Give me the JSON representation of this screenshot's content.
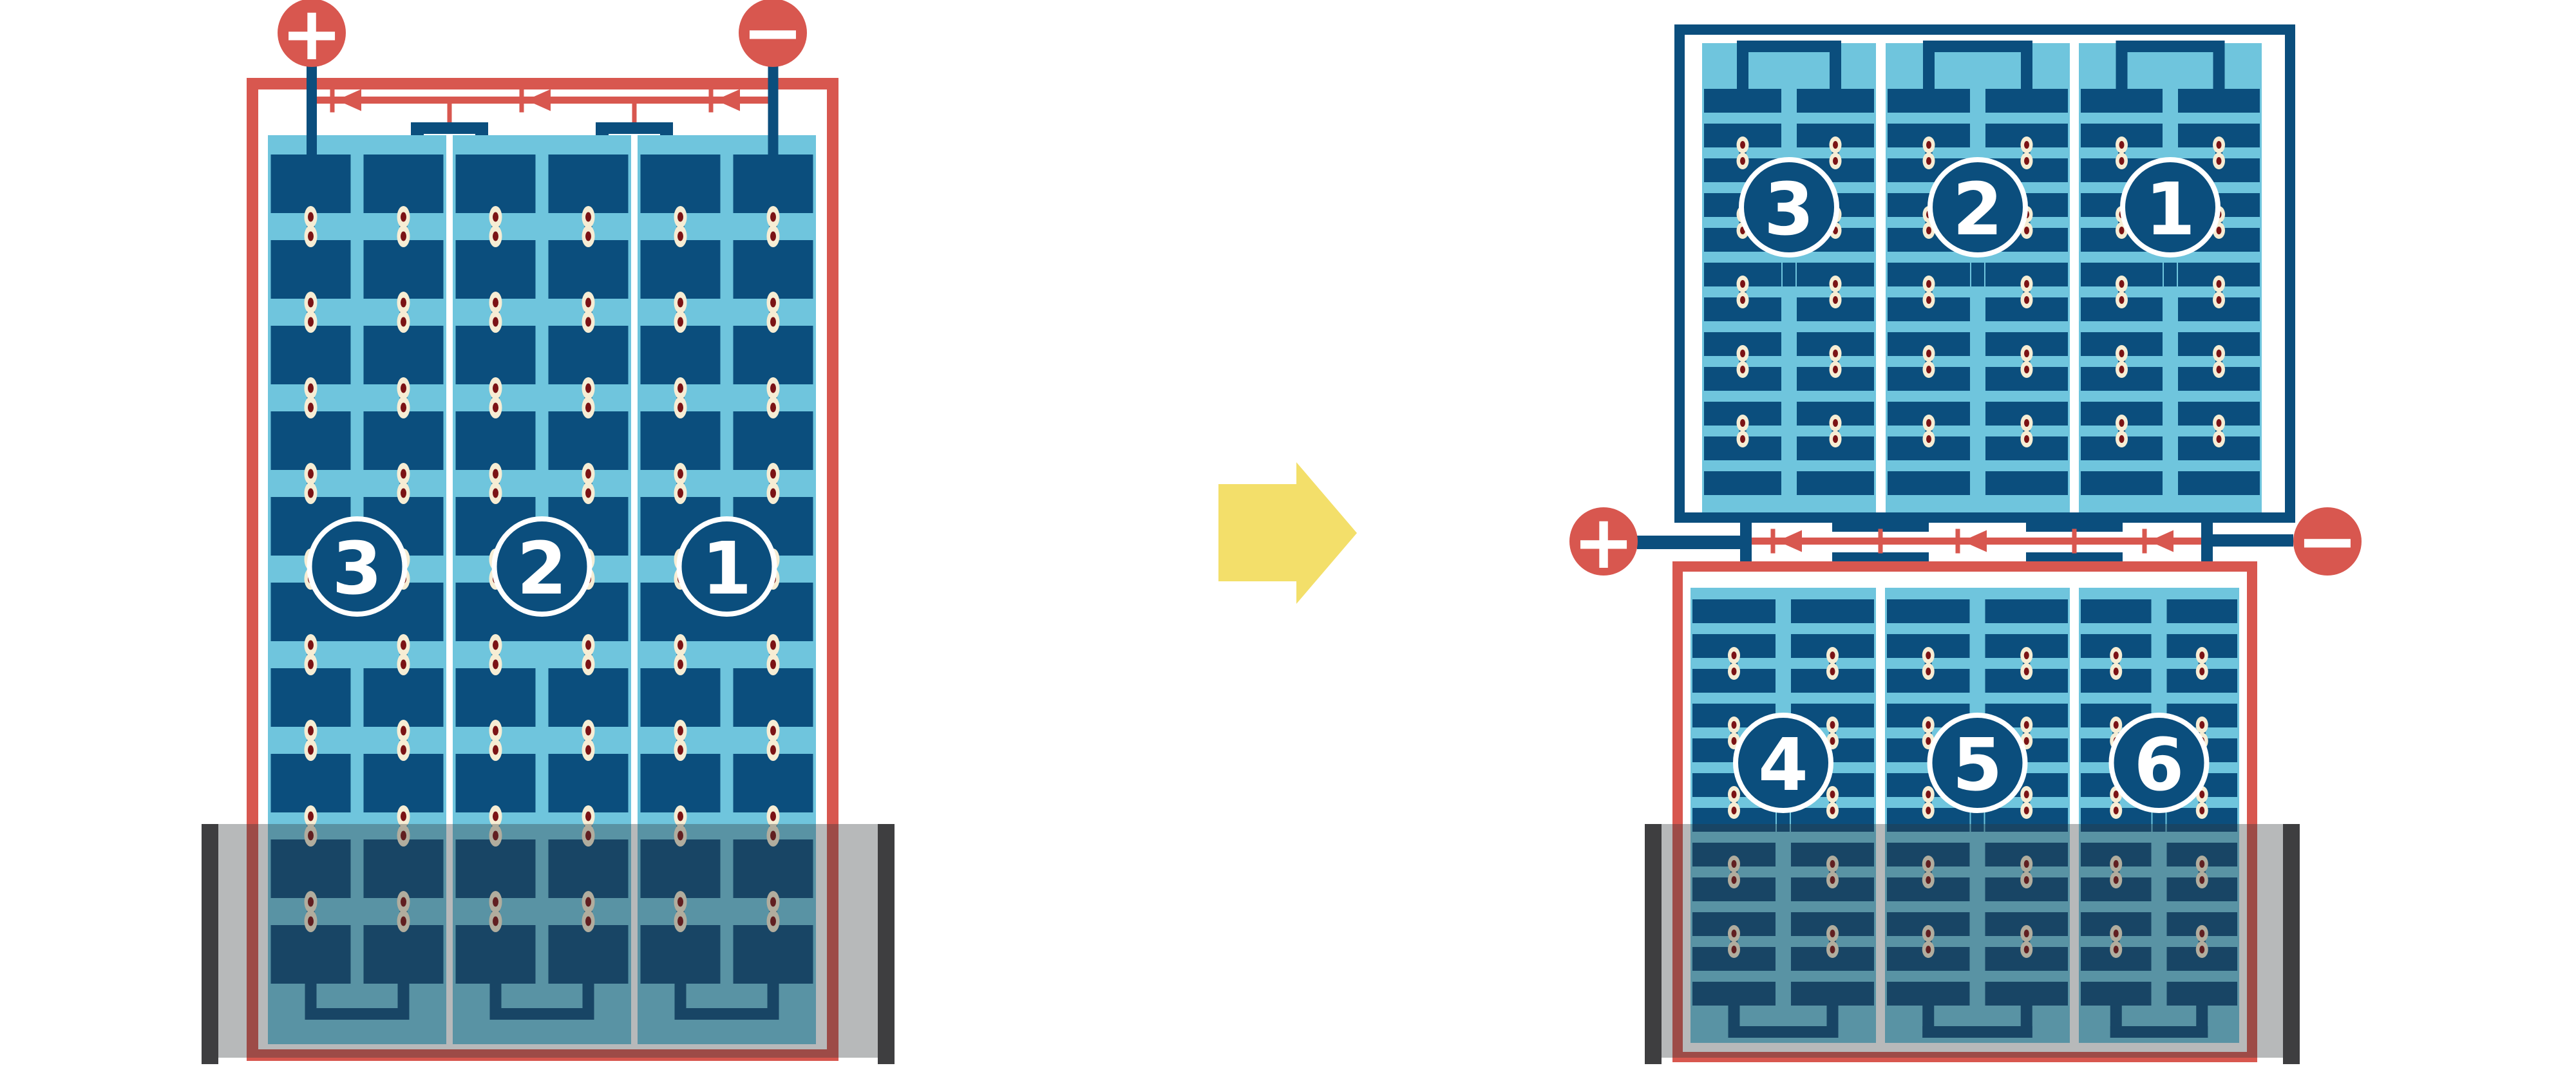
{
  "diagram": {
    "left_battery": {
      "positive_label": "+",
      "negative_label": "−",
      "cells": [
        {
          "label": "3"
        },
        {
          "label": "2"
        },
        {
          "label": "1"
        }
      ]
    },
    "right_battery": {
      "positive_label": "+",
      "negative_label": "−",
      "top_unit_cells": [
        {
          "label": "3"
        },
        {
          "label": "2"
        },
        {
          "label": "1"
        }
      ],
      "bottom_unit_cells": [
        {
          "label": "4"
        },
        {
          "label": "5"
        },
        {
          "label": "6"
        }
      ]
    },
    "colors": {
      "red": "#D8574F",
      "dark_blue": "#0B4E7D",
      "light_blue": "#6FC5DD",
      "cream": "#F6EDD4",
      "rivet_red": "#7B1315",
      "yellow": "#F3DF6A",
      "wall_gray": "#3E3E40",
      "overlay": "rgba(50,54,56,0.35)",
      "white": "#FFFFFF"
    }
  }
}
